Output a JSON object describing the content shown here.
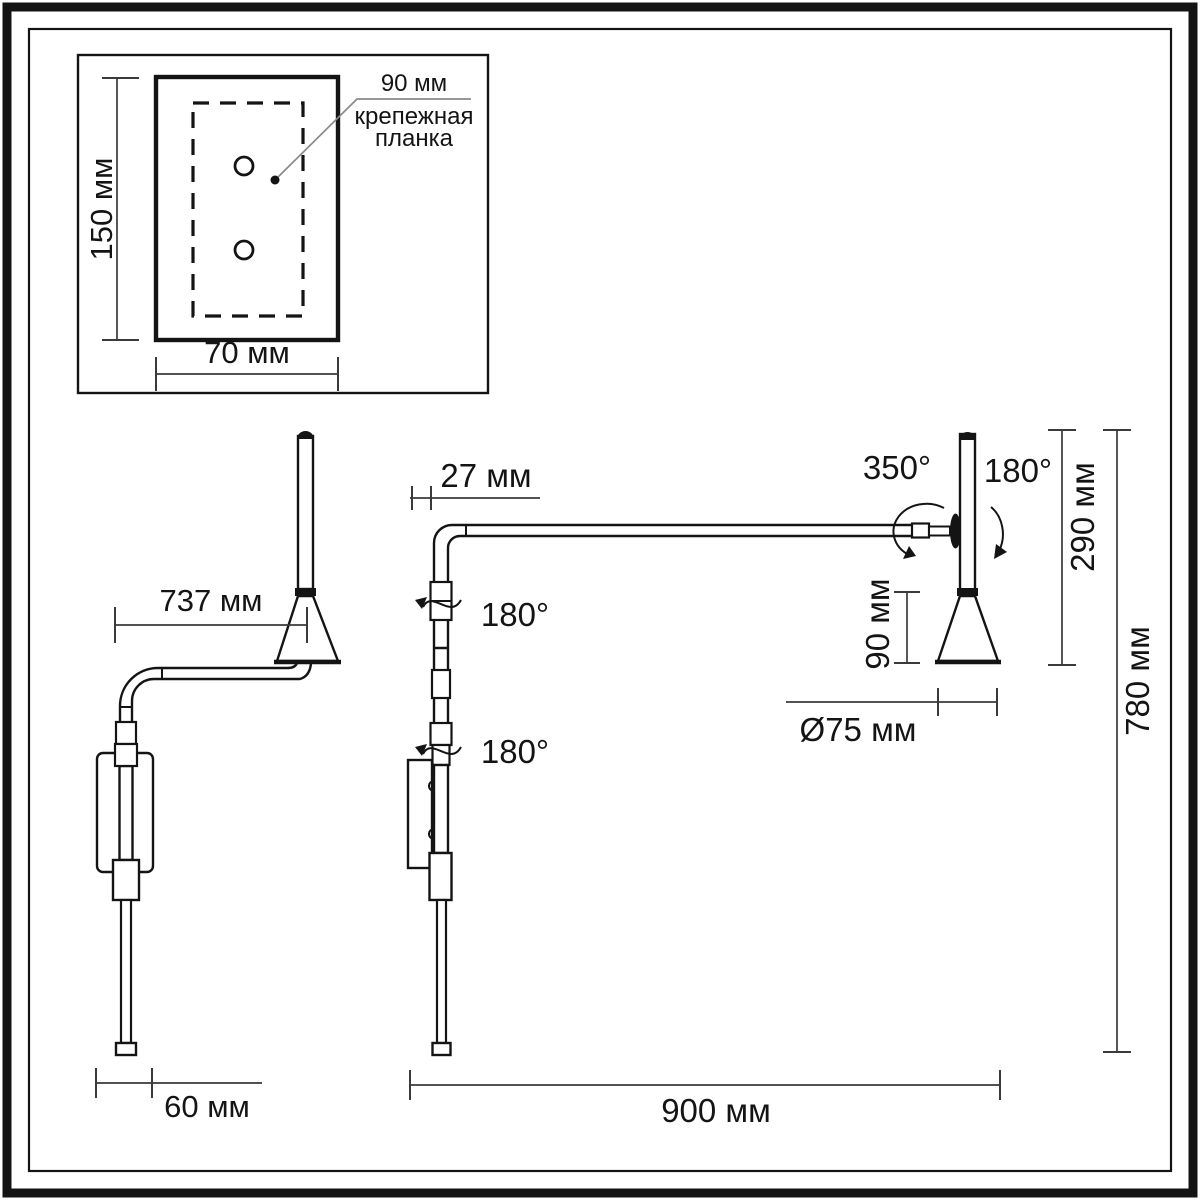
{
  "drawing": {
    "title": "wall-lamp-dimension-drawing",
    "units": "мм",
    "colors": {
      "line": "#141414",
      "dim": "#3a3a3a",
      "background": "#ffffff"
    },
    "inset": {
      "height": "150 мм",
      "width": "70 мм",
      "offset": "90 мм",
      "bracket_line1": "крепежная",
      "bracket_line2": "планка"
    },
    "side_view": {
      "arm_reach": "737 мм",
      "base_width": "60 мм"
    },
    "front_view": {
      "wall_offset": "27 мм",
      "upper_swivel": "180°",
      "lower_swivel": "180°",
      "head_rotation": "350°",
      "head_tilt": "180°",
      "head_height": "290 мм",
      "shade_height": "90 мм",
      "shade_diameter": "Ø75 мм",
      "total_drop": "780 мм",
      "arm_span": "900 мм"
    }
  }
}
